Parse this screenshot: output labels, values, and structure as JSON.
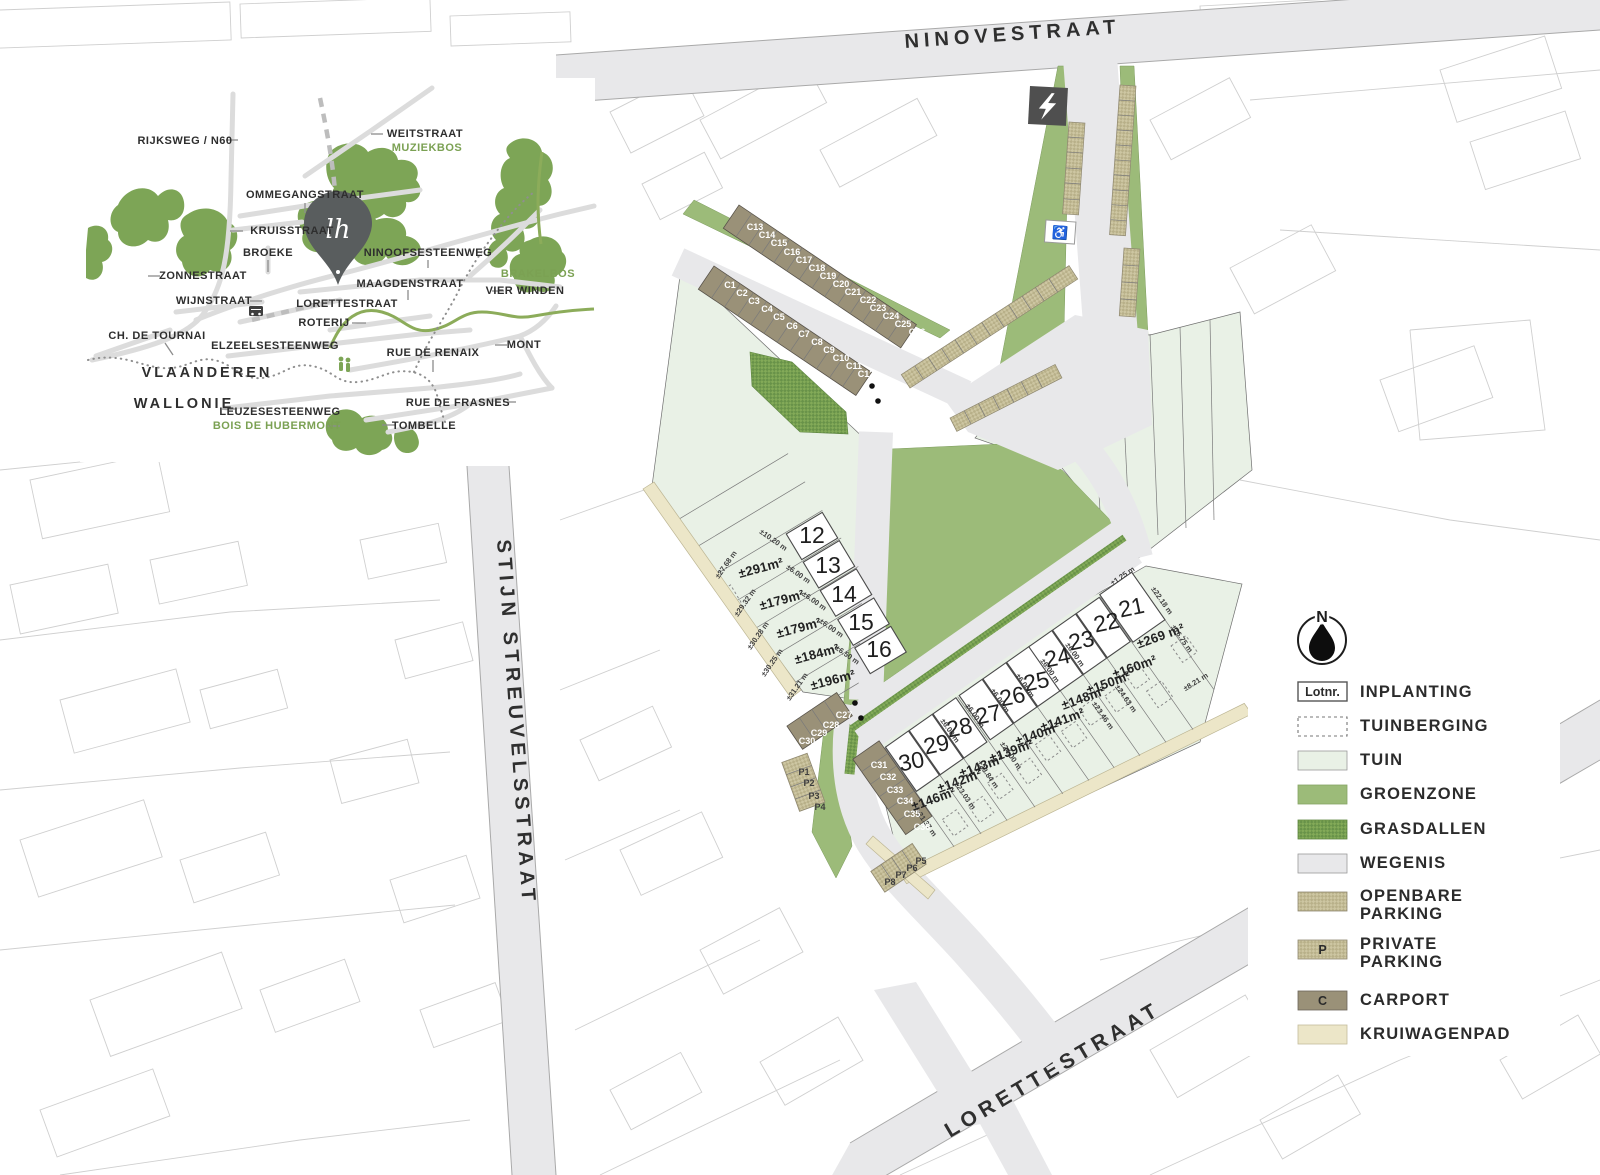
{
  "streets": {
    "ninovestraat": "NINOVESTRAAT",
    "stijn_streuvelsstraat": "STIJN STREUVELSSTRAAT",
    "lorettestraat": "LORETTESTRAAT"
  },
  "site": {
    "lots_left": [
      {
        "number": "12",
        "area": "±291m²"
      },
      {
        "number": "13",
        "area": "±179m²"
      },
      {
        "number": "14",
        "area": "±179m²"
      },
      {
        "number": "15",
        "area": "±184m²"
      },
      {
        "number": "16",
        "area": "±196m²"
      }
    ],
    "lots_right": [
      {
        "number": "21",
        "area": "±269 m²"
      },
      {
        "number": "22",
        "area": "±160m²"
      },
      {
        "number": "23",
        "area": "±150m²"
      },
      {
        "number": "24",
        "area": "±148m²"
      },
      {
        "number": "25",
        "area": "±141m²"
      },
      {
        "number": "26",
        "area": "±140m²"
      },
      {
        "number": "27",
        "area": "±139m²"
      },
      {
        "number": "28",
        "area": "±143m²"
      },
      {
        "number": "29",
        "area": "±142m²"
      },
      {
        "number": "30",
        "area": "±146m²"
      }
    ],
    "carports": [
      "C1",
      "C2",
      "C3",
      "C4",
      "C5",
      "C6",
      "C7",
      "C8",
      "C9",
      "C10",
      "C11",
      "C12",
      "C13",
      "C14",
      "C15",
      "C16",
      "C17",
      "C18",
      "C19",
      "C20",
      "C21",
      "C22",
      "C23",
      "C24",
      "C25",
      "C26",
      "C27",
      "C28",
      "C29",
      "C30",
      "C31",
      "C32",
      "C33",
      "C34",
      "C35",
      "C36"
    ],
    "private_parking": [
      "P1",
      "P2",
      "P3",
      "P4",
      "P5",
      "P6",
      "P7",
      "P8"
    ],
    "dims": [
      "±27.68 m",
      "±29.32 m",
      "±30.28 m",
      "±30.25 m",
      "±31.21 m",
      "±10.20 m",
      "±6.00 m",
      "±6.50 m",
      "±1.25 m",
      "±22.18 m",
      "±8.21 m",
      "±16.75 m",
      "±24.63 m",
      "±23.46 m",
      "±23.03 m",
      "±23.84 m",
      "±24.00 m",
      "±21.37 m"
    ],
    "accessible_parking_symbol": "♿"
  },
  "legend": {
    "north": "N",
    "items": [
      {
        "label": "INPLANTING",
        "swatch": "Lotnr."
      },
      {
        "label": "TUINBERGING"
      },
      {
        "label": "TUIN"
      },
      {
        "label": "GROENZONE"
      },
      {
        "label": "GRASDALLEN"
      },
      {
        "label": "WEGENIS"
      },
      {
        "label": "OPENBARE",
        "label2": "PARKING"
      },
      {
        "label": "PRIVATE",
        "label2": "PARKING",
        "swatch": "P"
      },
      {
        "label": "CARPORT",
        "swatch": "C"
      },
      {
        "label": "KRUIWAGENPAD"
      }
    ]
  },
  "inset": {
    "streets": {
      "rijksweg": "RIJKSWEG / N60",
      "weitstraat": "WEITSTRAAT",
      "ommegangstraat": "OMMEGANGSTRAAT",
      "kruisstraat": "KRUISSTRAAT",
      "broeke": "BROEKE",
      "ninoofsesteenweg": "NINOOFSESTEENWEG",
      "zonnestraat": "ZONNESTRAAT",
      "maagdenstraat": "MAAGDENSTRAAT",
      "wijnstraat": "WIJNSTRAAT",
      "lorettestraat": "LORETTESTRAAT",
      "vier_winden": "VIER WINDEN",
      "roterij": "ROTERIJ",
      "ch_de_tournai": "CH. DE TOURNAI",
      "elzeelsesteenweg": "ELZEELSESTEENWEG",
      "mont": "MONT",
      "rue_de_renaix": "RUE DE RENAIX",
      "leuzesesteenweg": "LEUZESESTEENWEG",
      "rue_de_frasnes": "RUE DE FRASNES",
      "tombelle": "TOMBELLE"
    },
    "areas": {
      "vlaanderen": "VLAANDEREN",
      "wallonie": "WALLONIE"
    },
    "woods": {
      "muziekbos": "MUZIEKBOS",
      "brakelbos": "BRAKELBOS",
      "bois_de_hubermont": "BOIS DE HUBERMONT"
    },
    "logo_monogram": "lh"
  }
}
